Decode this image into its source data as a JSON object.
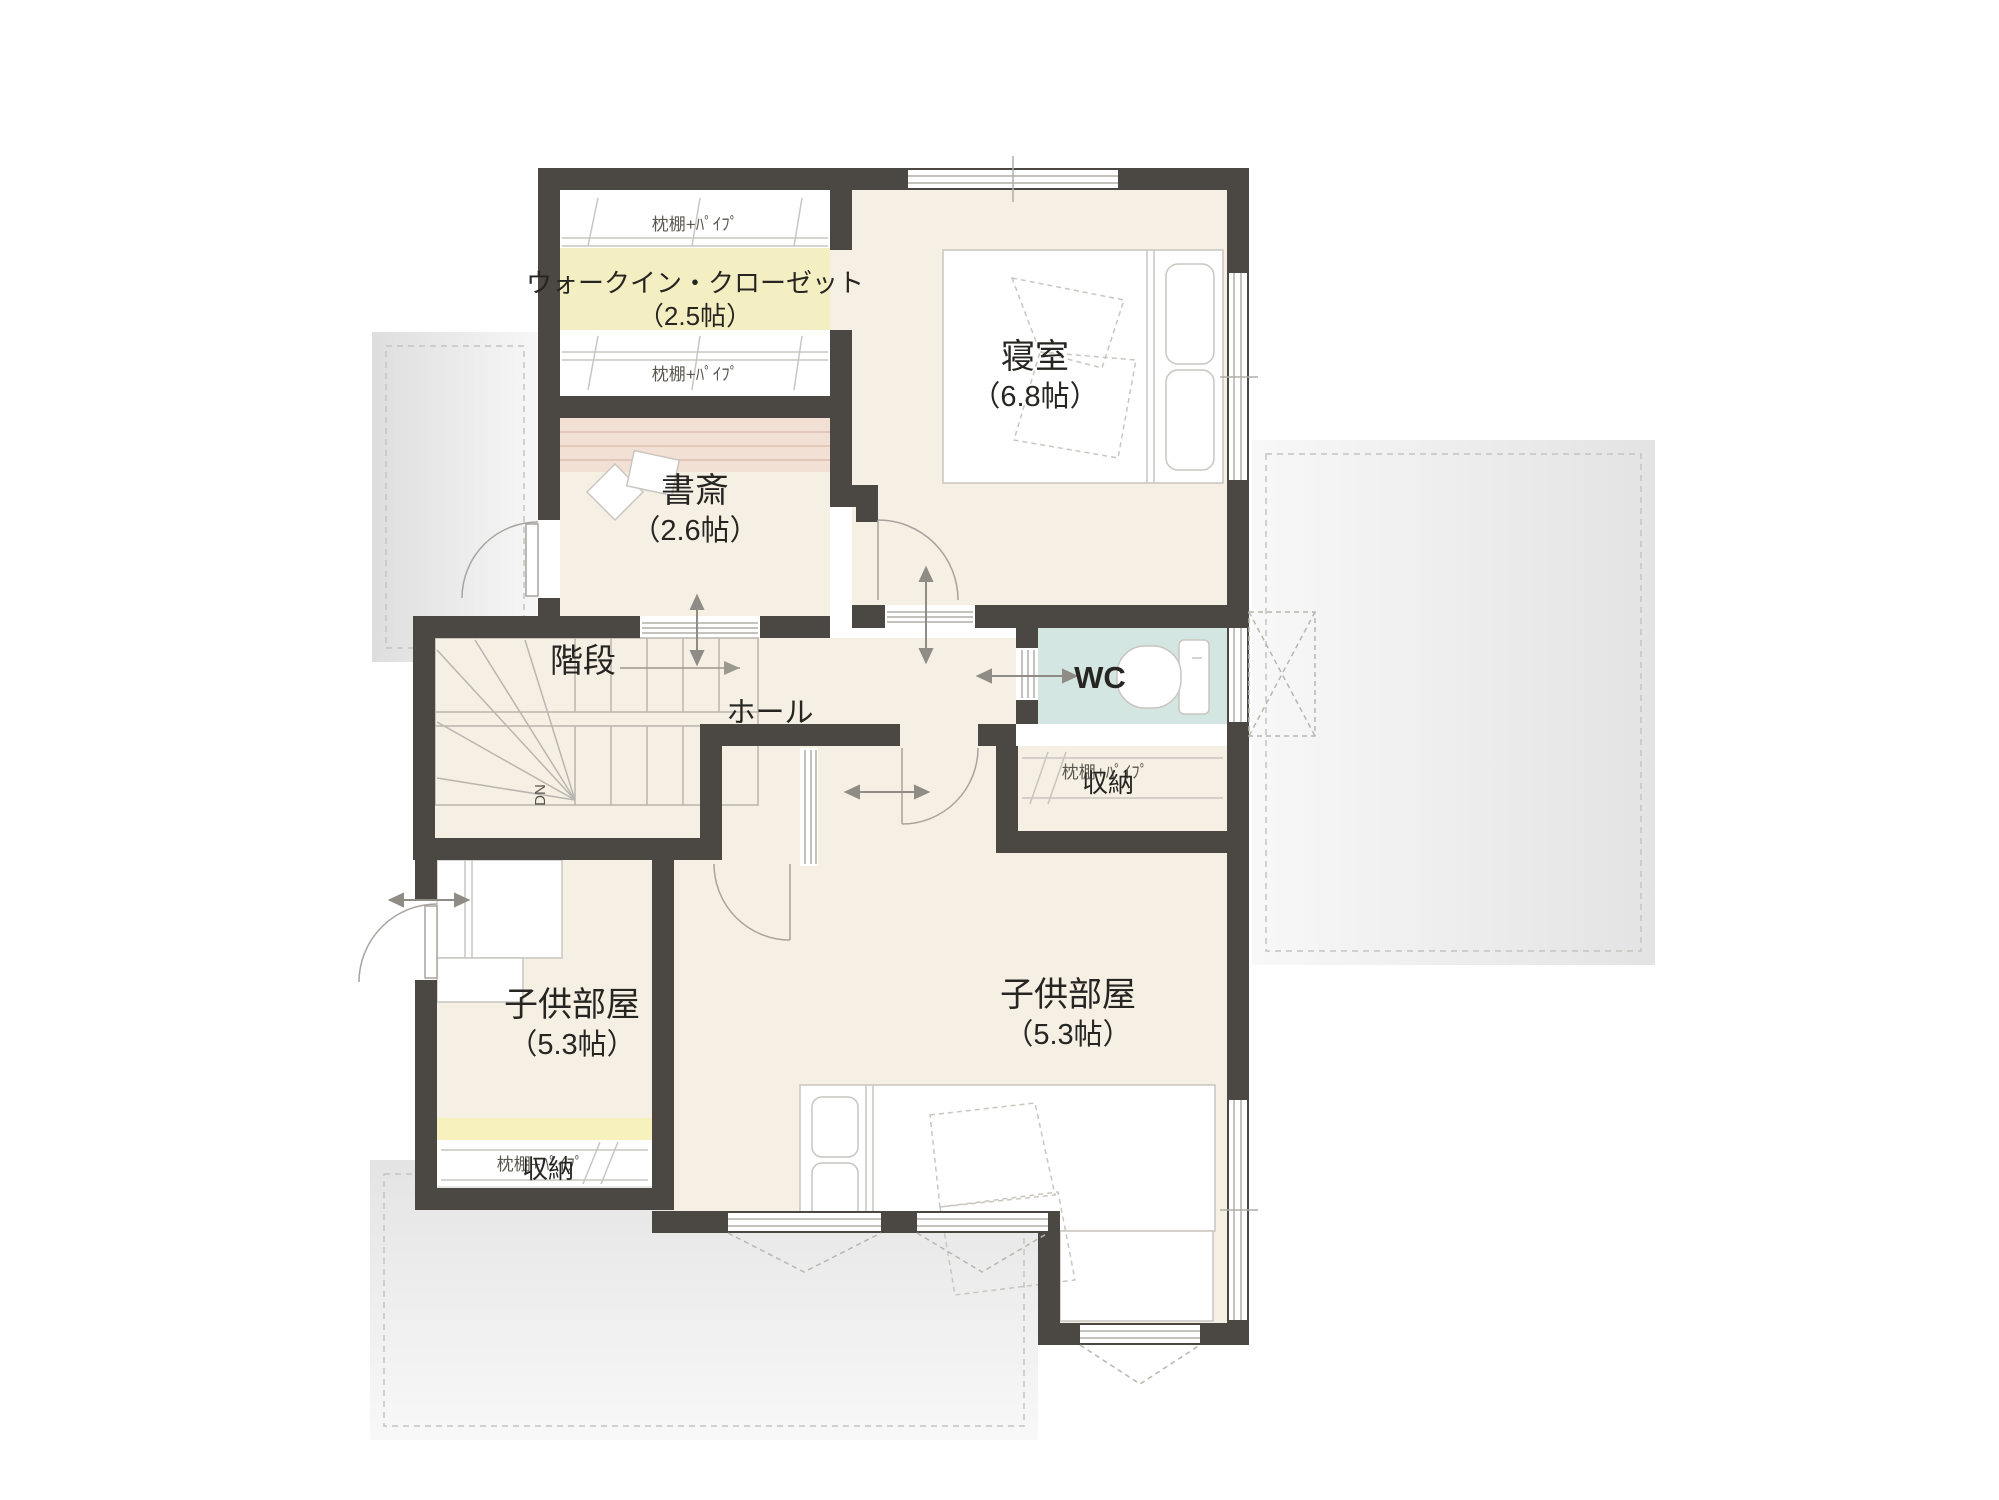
{
  "plan": {
    "type": "floorplan",
    "floor": "2F",
    "rooms": {
      "wic": {
        "name": "ウォークイン・クローゼット",
        "size": "（2.5帖）",
        "shelf_top": "枕棚+ﾊﾟｲﾌﾟ",
        "shelf_bottom": "枕棚+ﾊﾟｲﾌﾟ"
      },
      "bedroom": {
        "name": "寝室",
        "size": "（6.8帖）"
      },
      "study": {
        "name": "書斎",
        "size": "（2.6帖）"
      },
      "stairs": {
        "name": "階段",
        "down_label": "DN"
      },
      "hall": {
        "name": "ホール"
      },
      "wc": {
        "name": "WC"
      },
      "child_room_right": {
        "name": "子供部屋",
        "size": "（5.3帖）",
        "storage": {
          "name": "収納",
          "shelf": "枕棚+ﾊﾟｲﾌﾟ"
        }
      },
      "child_room_left": {
        "name": "子供部屋",
        "size": "（5.3帖）",
        "storage": {
          "name": "収納",
          "shelf": "枕棚+ﾊﾟｲﾌﾟ"
        }
      }
    },
    "colors": {
      "wall": "#4b4844",
      "floor": "#f5efe4",
      "wic_yellow": "#f4efc2",
      "storage_yellow": "#f6f1bd",
      "wc_blue": "#d4e6e2",
      "study_shelf": "#f2e0d4",
      "roof_gray": "#e7e7e7",
      "line_gray": "#b9b6af"
    }
  }
}
